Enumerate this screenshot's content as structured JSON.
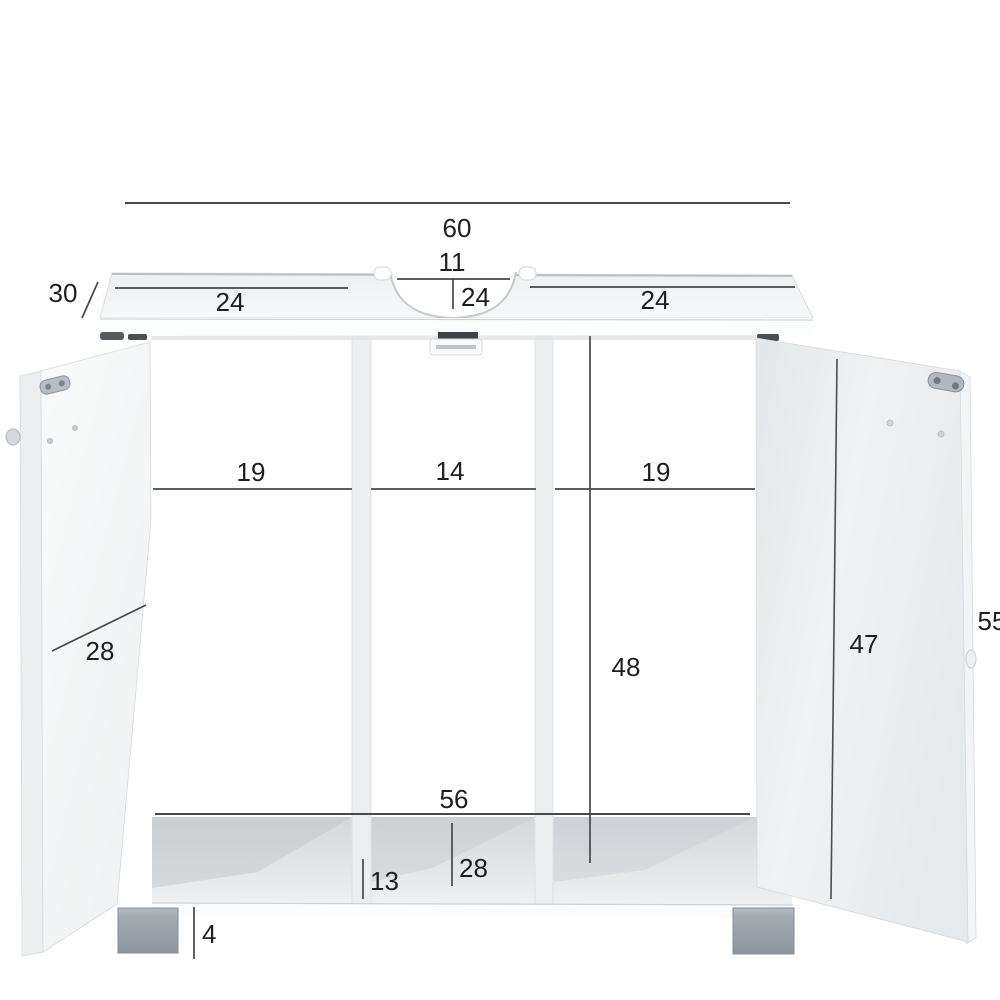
{
  "dims": {
    "top_total": "60",
    "cutout_width": "11",
    "top_left": "24",
    "top_center": "24",
    "top_right": "24",
    "depth": "30",
    "inner_left": "19",
    "inner_center": "14",
    "inner_right": "19",
    "inner_height": "48",
    "door_width": "28",
    "door_height": "47",
    "overall_height": "55",
    "bottom_width": "56",
    "bottom_center": "28",
    "bottom_left": "13",
    "leg_height": "4"
  },
  "colors": {
    "background": "#ffffff",
    "dimension_line": "#45484c",
    "label_text": "#1d1e1f",
    "cabinet_white": "#f4f5f6",
    "panel_gray": "#eaecee",
    "shelf_shadow": "#d5d9db",
    "leg_gray": "#99a0a7",
    "hinge_metal": "#b4bac0"
  }
}
